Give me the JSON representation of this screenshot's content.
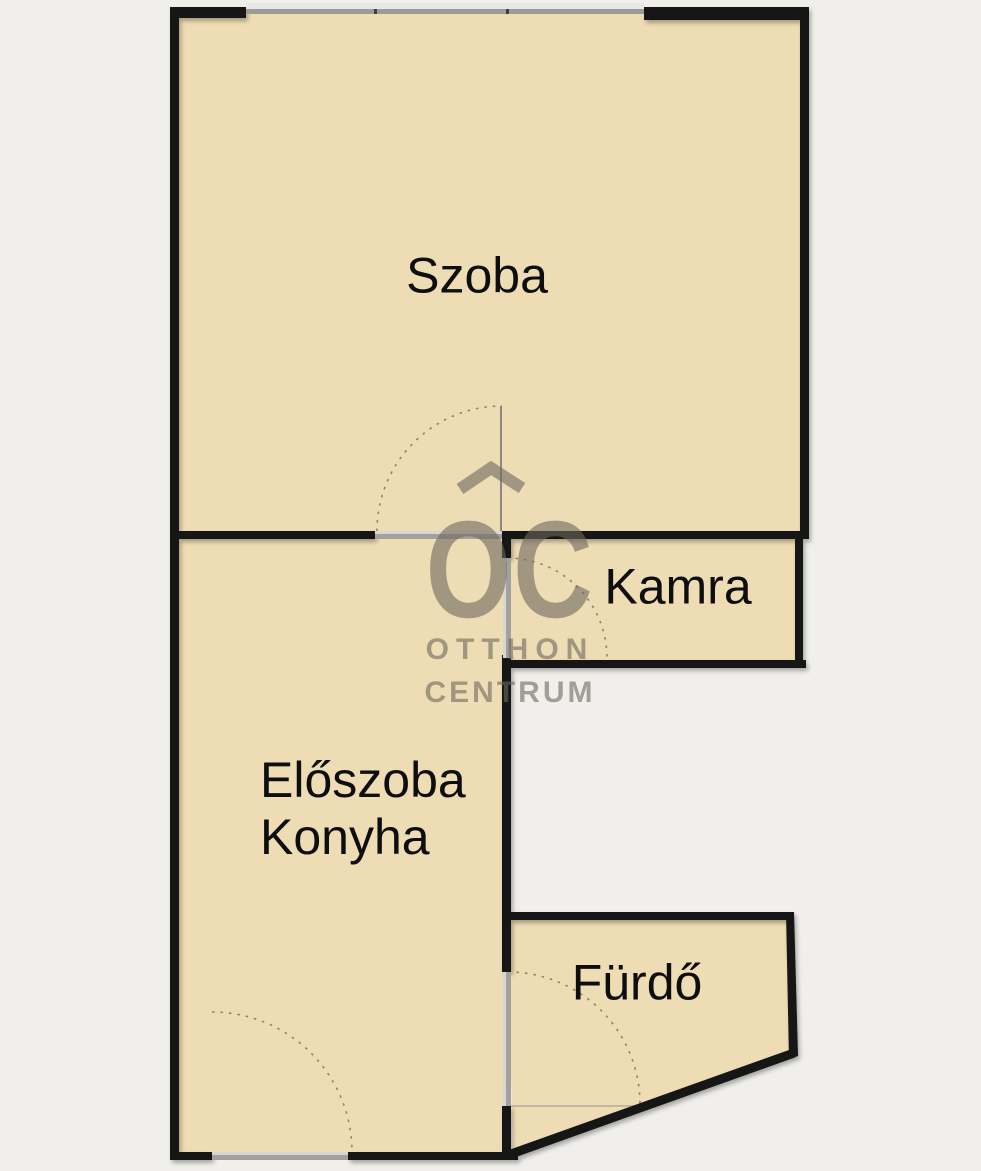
{
  "floorplan": {
    "rooms": {
      "szoba": {
        "label": "Szoba"
      },
      "kamra": {
        "label": "Kamra"
      },
      "eloszoba_konyha": {
        "label_line1": "Előszoba",
        "label_line2": "Konyha"
      },
      "furdo": {
        "label": "Fürdő"
      }
    },
    "watermark": {
      "monogram": "OC",
      "name_line1": "OTTHON",
      "name_line2": "CENTRUM"
    },
    "colors": {
      "background": "#f0efeb",
      "room_fill": "#eedcb4",
      "wall": "#141414",
      "opening": "#a3a19c",
      "opening_light": "#d9d7d3",
      "window_light": "#eae8e4",
      "window_dark": "#9d9b97",
      "door_arc": "#7d7460",
      "label_text": "#0e0e0e",
      "watermark": "rgba(110,104,94,0.6)"
    }
  }
}
